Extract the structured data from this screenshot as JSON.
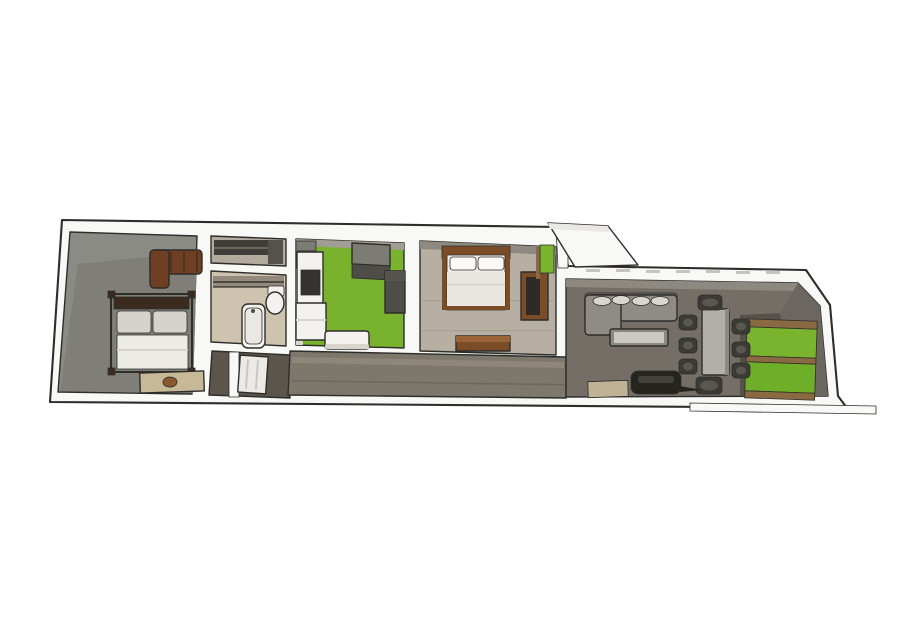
{
  "scene": {
    "type": "3d-floorplan-render",
    "view": "top-down oblique cutaway of a long narrow apartment, white background",
    "rooms": [
      {
        "id": "master-bedroom",
        "furniture": [
          "canopy-double-bed",
          "leather-sofa",
          "bench-with-bowl"
        ]
      },
      {
        "id": "closet",
        "furniture": [
          "dark-shelving"
        ]
      },
      {
        "id": "bathroom",
        "furniture": [
          "bathtub",
          "toilet",
          "shelf-rail"
        ]
      },
      {
        "id": "entry-hall",
        "furniture": [
          "open-entry-door"
        ]
      },
      {
        "id": "kitchen",
        "furniture": [
          "counter-with-cooktop",
          "upper-shelf",
          "refrigerator",
          "tall-unit",
          "white-cabinet",
          "side-table"
        ]
      },
      {
        "id": "bedroom",
        "furniture": [
          "double-bed",
          "wardrobe",
          "foot-bench",
          "green-door"
        ]
      },
      {
        "id": "corridor",
        "furniture": []
      },
      {
        "id": "living-dining",
        "furniture": [
          "corner-sofa",
          "coffee-table",
          "dining-table",
          "eight-chairs",
          "fireplace",
          "doormat",
          "green-end-windows"
        ]
      }
    ]
  },
  "colors": {
    "bg": "#ffffff",
    "wall_white": "#f8f8f6",
    "wall_white_shade": "#e9e8e4",
    "room1_wall": "#8b8b85",
    "room1_floor": "#7f7f78",
    "closet_floor": "#b3ab9d",
    "closet_shelf": "#413e39",
    "closet_shelf_line": "#6b675e",
    "closet_return": "#55524b",
    "bath_floor": "#cdc3ae",
    "bath_shelf": "#93897c",
    "bath_rail": "#4f4a42",
    "entry_floor": "#5b554c",
    "kitchen_floor": "#79b32e",
    "kitchen_wall": "#a19d94",
    "kitchen_left_strip": "#d9d6cf",
    "appliance_gray": "#7c7b74",
    "appliance_dark": "#4e4d47",
    "appliance_line": "#55534d",
    "cooktop_dark": "#35332f",
    "furn_white": "#f3f2ee",
    "furn_white_shade": "#d8d5cf",
    "bedroom_floor": "#b6afa2",
    "bedroom_wall": "#8f8a81",
    "plank_light": "#a79f92",
    "wood_brown": "#7a4c28",
    "wood_brown_light": "#9a6436",
    "wardrobe_panel": "#2e2a25",
    "window_green": "#7ab42f",
    "window_green2": "#6fae28",
    "wood_frame": "#8a6a43",
    "bedding_white": "#edebe6",
    "duvet": "#e9e6e0",
    "duvet_fold": "#d6d2cb",
    "pillow_gray": "#d6d3cd",
    "pillow_white": "#fbfaf8",
    "bed_frame_dark": "#3a2b1e",
    "sofa_brown": "#6f3f23",
    "sofa_brown_dark": "#55301a",
    "bench_tan": "#c7b997",
    "bench_knob": "#8a5a2e",
    "corridor_floor": "#7e776b",
    "corridor_streak": "#8d8679",
    "corridor_line": "#6d675d",
    "living_floor": "#746e66",
    "living_wall": "#8d8880",
    "right_wall_dark": "#6b6660",
    "right_floor_dark": "#56514a",
    "sofa_gray": "#8f8c85",
    "sofa_gray_dark": "#6e6b64",
    "cushion_light": "#d9d6cf",
    "table_top": "#b3b0a9",
    "table_side": "#8c8981",
    "table_inner": "#ccc9c2",
    "chair_dark": "#3b3a35",
    "chair_seat": "#5a5750",
    "fireplace_dark": "#26241f",
    "fireplace_inner": "#45423b",
    "mat_tan": "#c0b294",
    "dash_gray": "#c6c4be",
    "door_white": "#eceae6",
    "door_line": "#c9c7c1"
  }
}
